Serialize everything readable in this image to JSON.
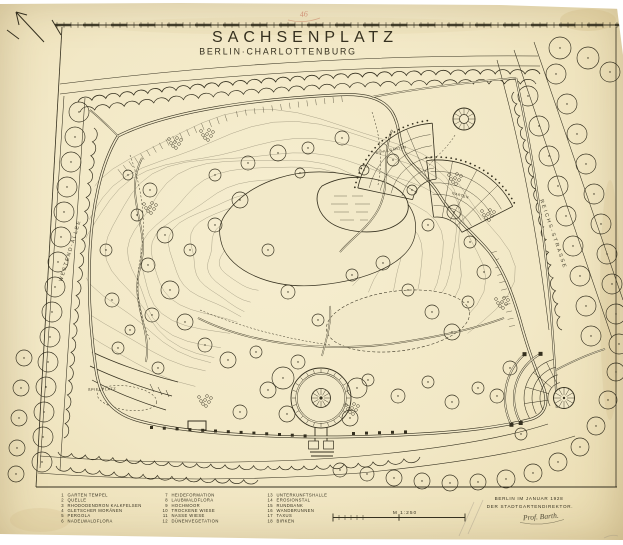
{
  "title": {
    "main": "SACHSENPLATZ",
    "sub": "BERLIN·CHARLOTTENBURG"
  },
  "stamp": {
    "text": "46"
  },
  "streets": {
    "left": "WESTEND-ALLEE",
    "right": "REICHS-STRASSE"
  },
  "park_labels": {
    "playground": "SPIELPLATZ",
    "fan_left": "SCHULGARTEN",
    "fan_right": "GARTEN"
  },
  "legend": {
    "columns": [
      {
        "items": [
          {
            "num": "1",
            "label": "GARTEN TEMPEL"
          },
          {
            "num": "2",
            "label": "QUELLE"
          },
          {
            "num": "3",
            "label": "RHODODENDRON KALKFELSEN"
          },
          {
            "num": "4",
            "label": "GLETSCHER MORÄNEN"
          },
          {
            "num": "5",
            "label": "PERGOLA"
          },
          {
            "num": "6",
            "label": "NADELWALDFLORA"
          }
        ]
      },
      {
        "items": [
          {
            "num": "7",
            "label": "HEIDEFORMATION"
          },
          {
            "num": "8",
            "label": "LAUBWALDFLORA"
          },
          {
            "num": "9",
            "label": "HOCHMOOR"
          },
          {
            "num": "10",
            "label": "TROCKENE WIESE"
          },
          {
            "num": "11",
            "label": "NASSE WIESE"
          },
          {
            "num": "12",
            "label": "DÜNENVEGETATION"
          }
        ]
      },
      {
        "items": [
          {
            "num": "13",
            "label": "UNTERKUNFTSHALLE"
          },
          {
            "num": "14",
            "label": "EROSIONSTAL"
          },
          {
            "num": "15",
            "label": "RUNDBANK"
          },
          {
            "num": "16",
            "label": "WANDBRUNNEN"
          },
          {
            "num": "17",
            "label": "TAXUS"
          },
          {
            "num": "18",
            "label": "BIRKEN"
          }
        ]
      }
    ]
  },
  "scale": {
    "label": "M 1:250"
  },
  "imprint": {
    "place_date": "BERLIN IM JANUAR 1928",
    "author": "DER STADTGARTENDIREKTOR.",
    "signature": "Prof. Barth."
  },
  "colors": {
    "paper": "#f2e9c9",
    "ink": "#35301f",
    "stamp_red": "#b5442f"
  }
}
